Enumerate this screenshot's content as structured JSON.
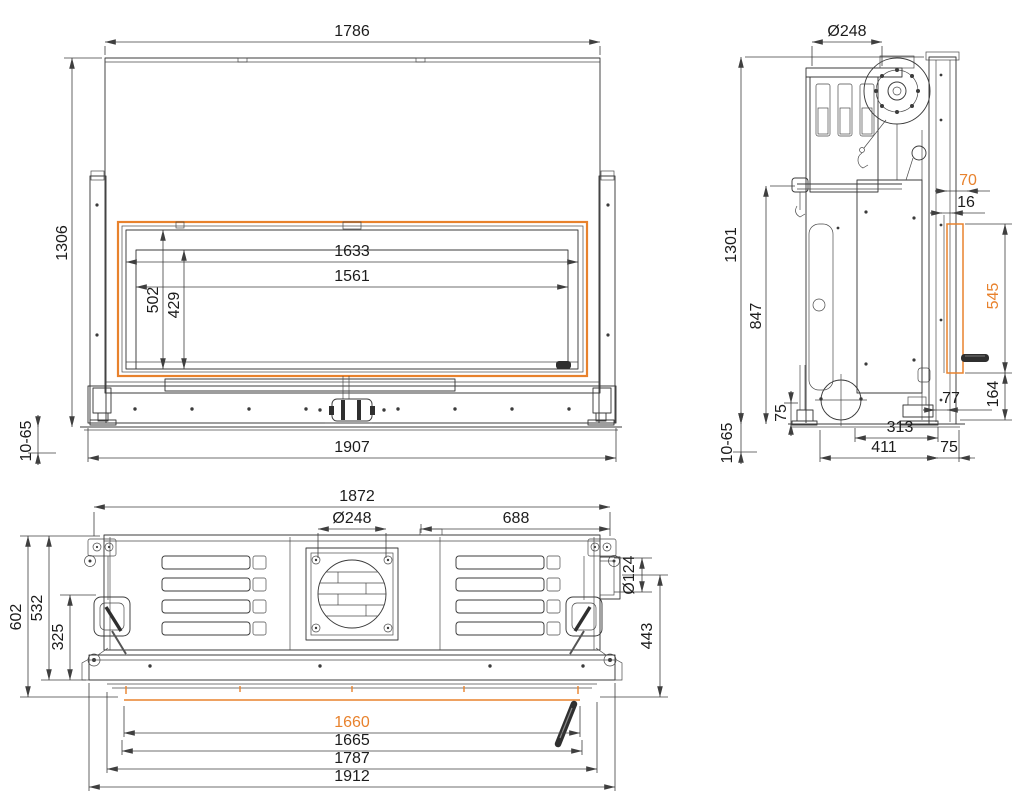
{
  "drawing": {
    "type": "technical-orthographic-drawing",
    "accent_color": "#e8822d",
    "line_color": "#3b3b3b",
    "accent_dimensions": [
      "70",
      "545",
      "1660"
    ]
  },
  "dims": {
    "front": {
      "w_top": "1786",
      "h_total": "1306",
      "w_open": "1633",
      "w_glass": "1561",
      "h_open": "502",
      "h_glass": "429",
      "adjust": "10-65",
      "w_base": "1907"
    },
    "side": {
      "flue": "Ø248",
      "h_total": "1301",
      "h_rod": "847",
      "h_foot": "75",
      "adjust": "10-65",
      "d_fan": "313",
      "d_body": "411",
      "d_offset": "75",
      "d_frame": "70",
      "d_gap": "16",
      "h_door": "545",
      "h_base": "164",
      "d_door": "77"
    },
    "top": {
      "w_body": "1872",
      "flue": "Ø248",
      "flue_offset": "688",
      "duct": "Ø124",
      "d_total": "602",
      "d_front": "532",
      "d_inner": "325",
      "d_right": "443",
      "w_glass_inner": "1660",
      "w_glass": "1665",
      "w_front": "1787",
      "w_total": "1912"
    }
  }
}
